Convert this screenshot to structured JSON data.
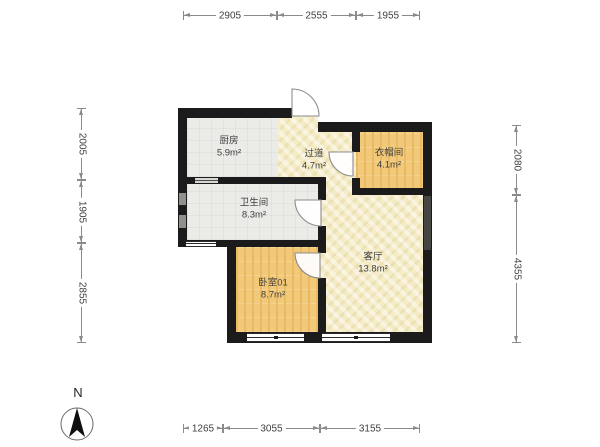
{
  "floorplan": {
    "rooms": {
      "kitchen": {
        "name": "厨房",
        "area": "5.9m²"
      },
      "hallway": {
        "name": "过道",
        "area": "4.7m²"
      },
      "cloakroom": {
        "name": "衣帽间",
        "area": "4.1m²"
      },
      "bathroom": {
        "name": "卫生间",
        "area": "8.3m²"
      },
      "bedroom": {
        "name": "卧室01",
        "area": "8.7m²"
      },
      "living": {
        "name": "客厅",
        "area": "13.8m²"
      }
    },
    "dims": {
      "top": [
        "2905",
        "2555",
        "1955"
      ],
      "bottom": [
        "1265",
        "3055",
        "3155"
      ],
      "left": [
        "2005",
        "1905",
        "2855"
      ],
      "right": [
        "2080",
        "4355"
      ]
    },
    "compass": {
      "north_label": "N"
    },
    "colors": {
      "wall": "#1b1b1b",
      "wood_floor": "#f2c97b",
      "tan_floor": "#f5ecc6",
      "gray_floor": "#ebebe8",
      "dim_line": "#8a8a8a",
      "label_text": "#3f3f3f",
      "background": "#ffffff"
    }
  }
}
